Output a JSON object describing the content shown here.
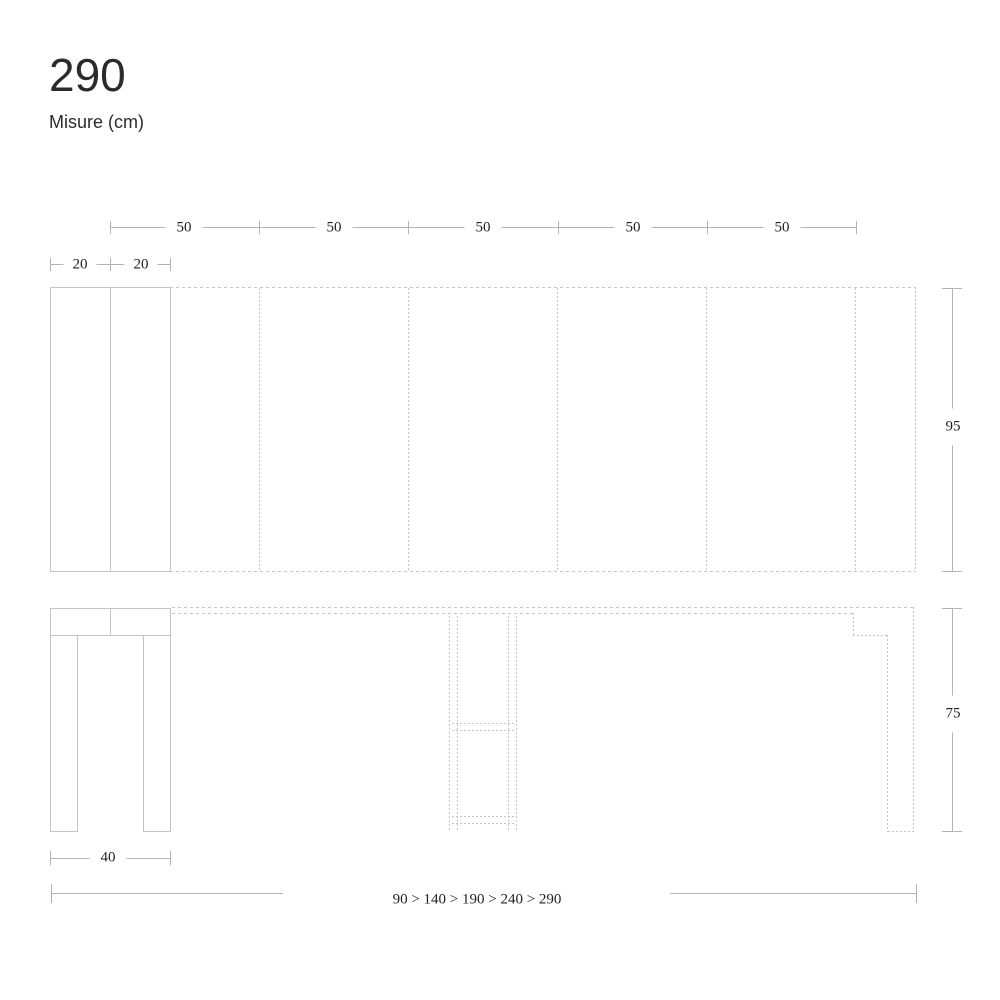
{
  "page": {
    "title": "290",
    "subtitle": "Misure (cm)"
  },
  "drawing": {
    "top_width_segments": [
      "50",
      "50",
      "50",
      "50",
      "50"
    ],
    "closed_top_segments": [
      "20",
      "20"
    ],
    "depth_label": "95",
    "height_label": "75",
    "base_width_label": "40",
    "extension_sequence": "90 > 140 > 190 > 240 > 290"
  },
  "colors": {
    "line": "#c4c4c4",
    "dim_line": "#b3b3b3",
    "text": "#1f1f1f",
    "title_text": "#2b2b2b"
  }
}
